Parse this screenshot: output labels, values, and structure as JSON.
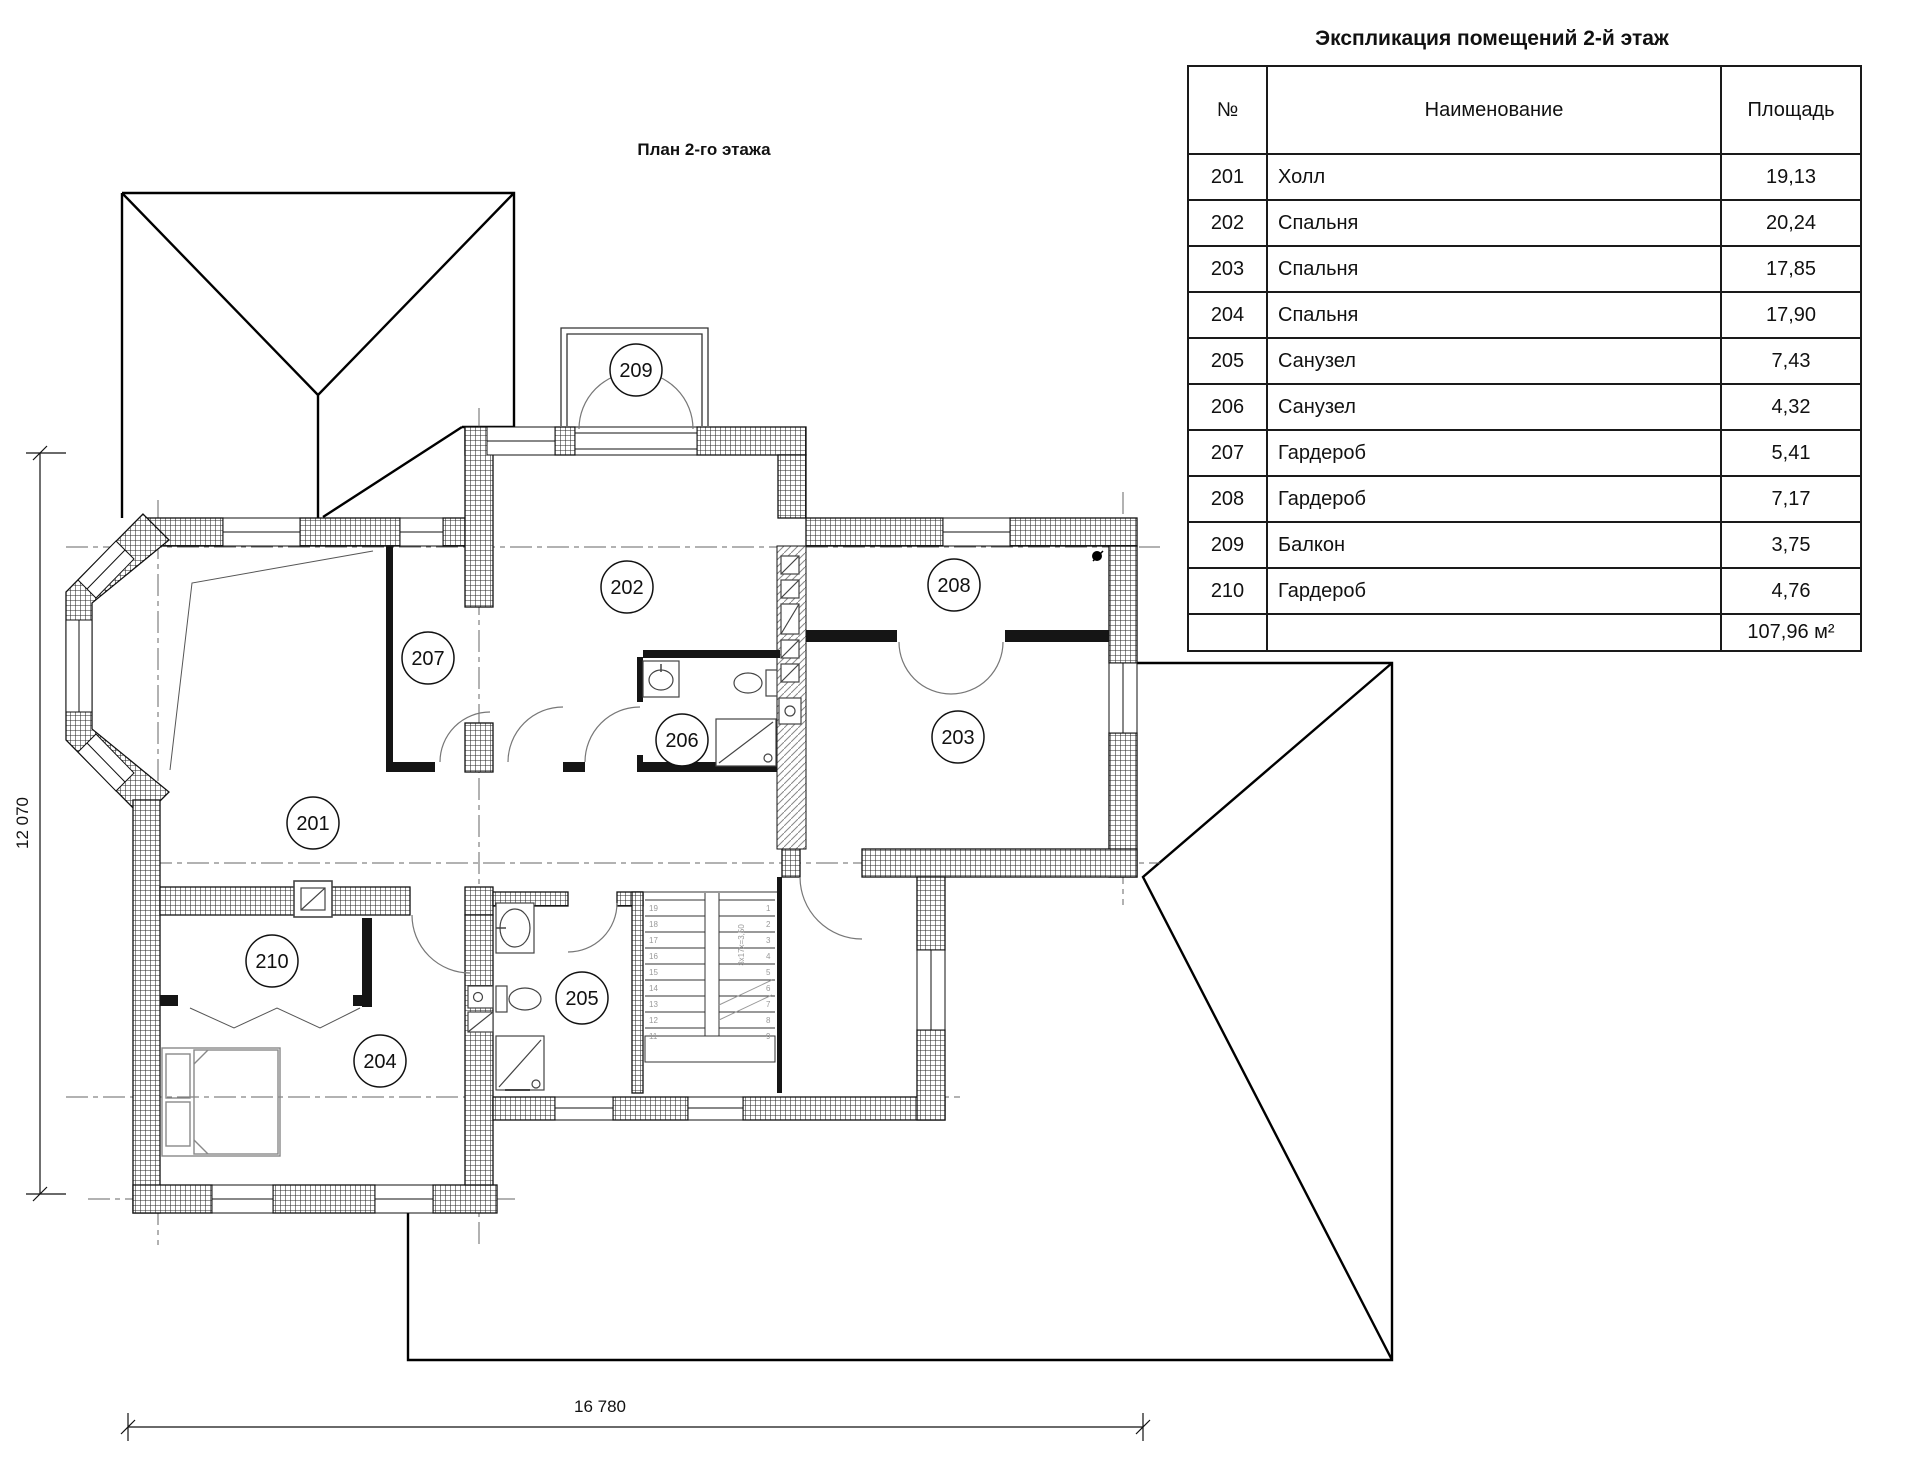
{
  "plan_title": "План 2-го этажа",
  "table": {
    "title": "Экспликация помещений 2-й этаж",
    "headers": {
      "num": "№",
      "name": "Наименование",
      "area": "Площадь"
    },
    "rows": [
      {
        "num": "201",
        "name": "Холл",
        "area": "19,13"
      },
      {
        "num": "202",
        "name": "Спальня",
        "area": "20,24"
      },
      {
        "num": "203",
        "name": "Спальня",
        "area": "17,85"
      },
      {
        "num": "204",
        "name": "Спальня",
        "area": "17,90"
      },
      {
        "num": "205",
        "name": "Санузел",
        "area": "7,43"
      },
      {
        "num": "206",
        "name": "Санузел",
        "area": "4,32"
      },
      {
        "num": "207",
        "name": "Гардероб",
        "area": "5,41"
      },
      {
        "num": "208",
        "name": "Гардероб",
        "area": "7,17"
      },
      {
        "num": "209",
        "name": "Балкон",
        "area": "3,75"
      },
      {
        "num": "210",
        "name": "Гардероб",
        "area": "4,76"
      }
    ],
    "total_area": "107,96 м²"
  },
  "plan": {
    "room_labels": [
      {
        "num": "201",
        "x": 313,
        "y": 823
      },
      {
        "num": "202",
        "x": 627,
        "y": 587
      },
      {
        "num": "203",
        "x": 958,
        "y": 737
      },
      {
        "num": "204",
        "x": 380,
        "y": 1061
      },
      {
        "num": "205",
        "x": 582,
        "y": 998
      },
      {
        "num": "206",
        "x": 682,
        "y": 740
      },
      {
        "num": "207",
        "x": 428,
        "y": 658
      },
      {
        "num": "208",
        "x": 954,
        "y": 585
      },
      {
        "num": "209",
        "x": 636,
        "y": 370
      },
      {
        "num": "210",
        "x": 272,
        "y": 961
      }
    ],
    "dimensions": {
      "left_vertical": "12 070",
      "bottom_horizontal": "16 780"
    },
    "stairs": {
      "note": "3x17x=3,50",
      "left_numbers": [
        "19",
        "18",
        "17",
        "16",
        "15",
        "14",
        "13",
        "12",
        "11"
      ],
      "right_numbers": [
        "1",
        "2",
        "3",
        "4",
        "5",
        "6",
        "7",
        "8",
        "9"
      ]
    }
  }
}
